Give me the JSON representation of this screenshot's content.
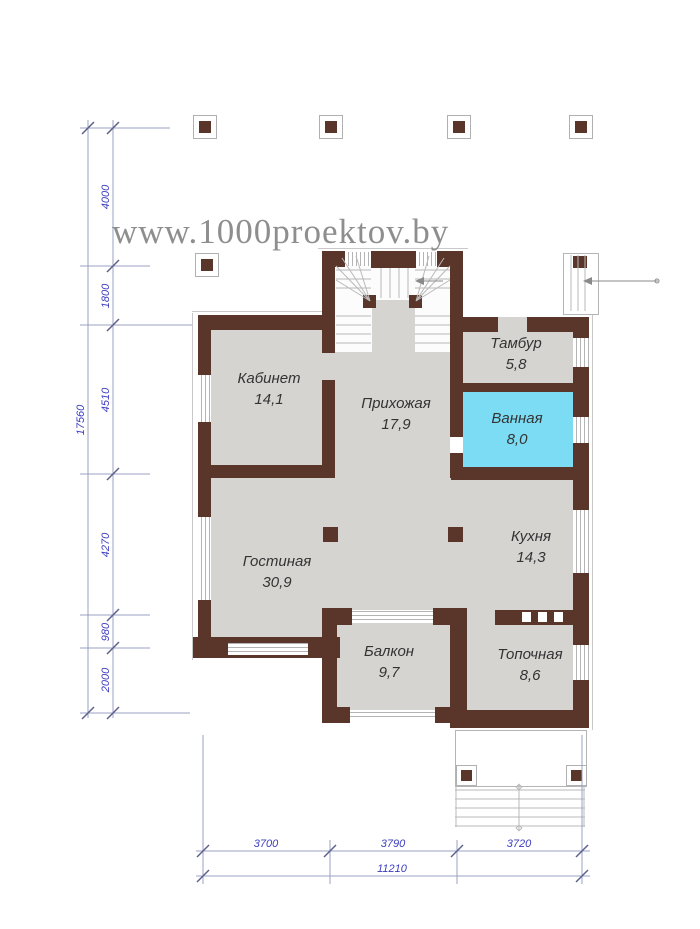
{
  "watermark": "www.1000proektov.by",
  "colors": {
    "wall": "#59352a",
    "floor": "#d6d4d1",
    "bath": "#7cdcf4",
    "dim_text": "#3d3dc0",
    "dim_line": "#9aa0c0",
    "watermark": "#8e8e8e",
    "label": "#333333"
  },
  "plan": {
    "rooms": [
      {
        "name": "Кабинет",
        "area": "14,1"
      },
      {
        "name": "Прихожая",
        "area": "17,9"
      },
      {
        "name": "Тамбур",
        "area": "5,8"
      },
      {
        "name": "Ванная",
        "area": "8,0"
      },
      {
        "name": "Гостиная",
        "area": "30,9"
      },
      {
        "name": "Кухня",
        "area": "14,3"
      },
      {
        "name": "Балкон",
        "area": "9,7"
      },
      {
        "name": "Топочная",
        "area": "8,6"
      }
    ]
  },
  "dimensions": {
    "left_total": "17560",
    "left_segments": [
      "4000",
      "1800",
      "4510",
      "4270",
      "980",
      "2000"
    ],
    "bottom_segments": [
      "3700",
      "3790",
      "3720"
    ],
    "bottom_total": "11210"
  }
}
